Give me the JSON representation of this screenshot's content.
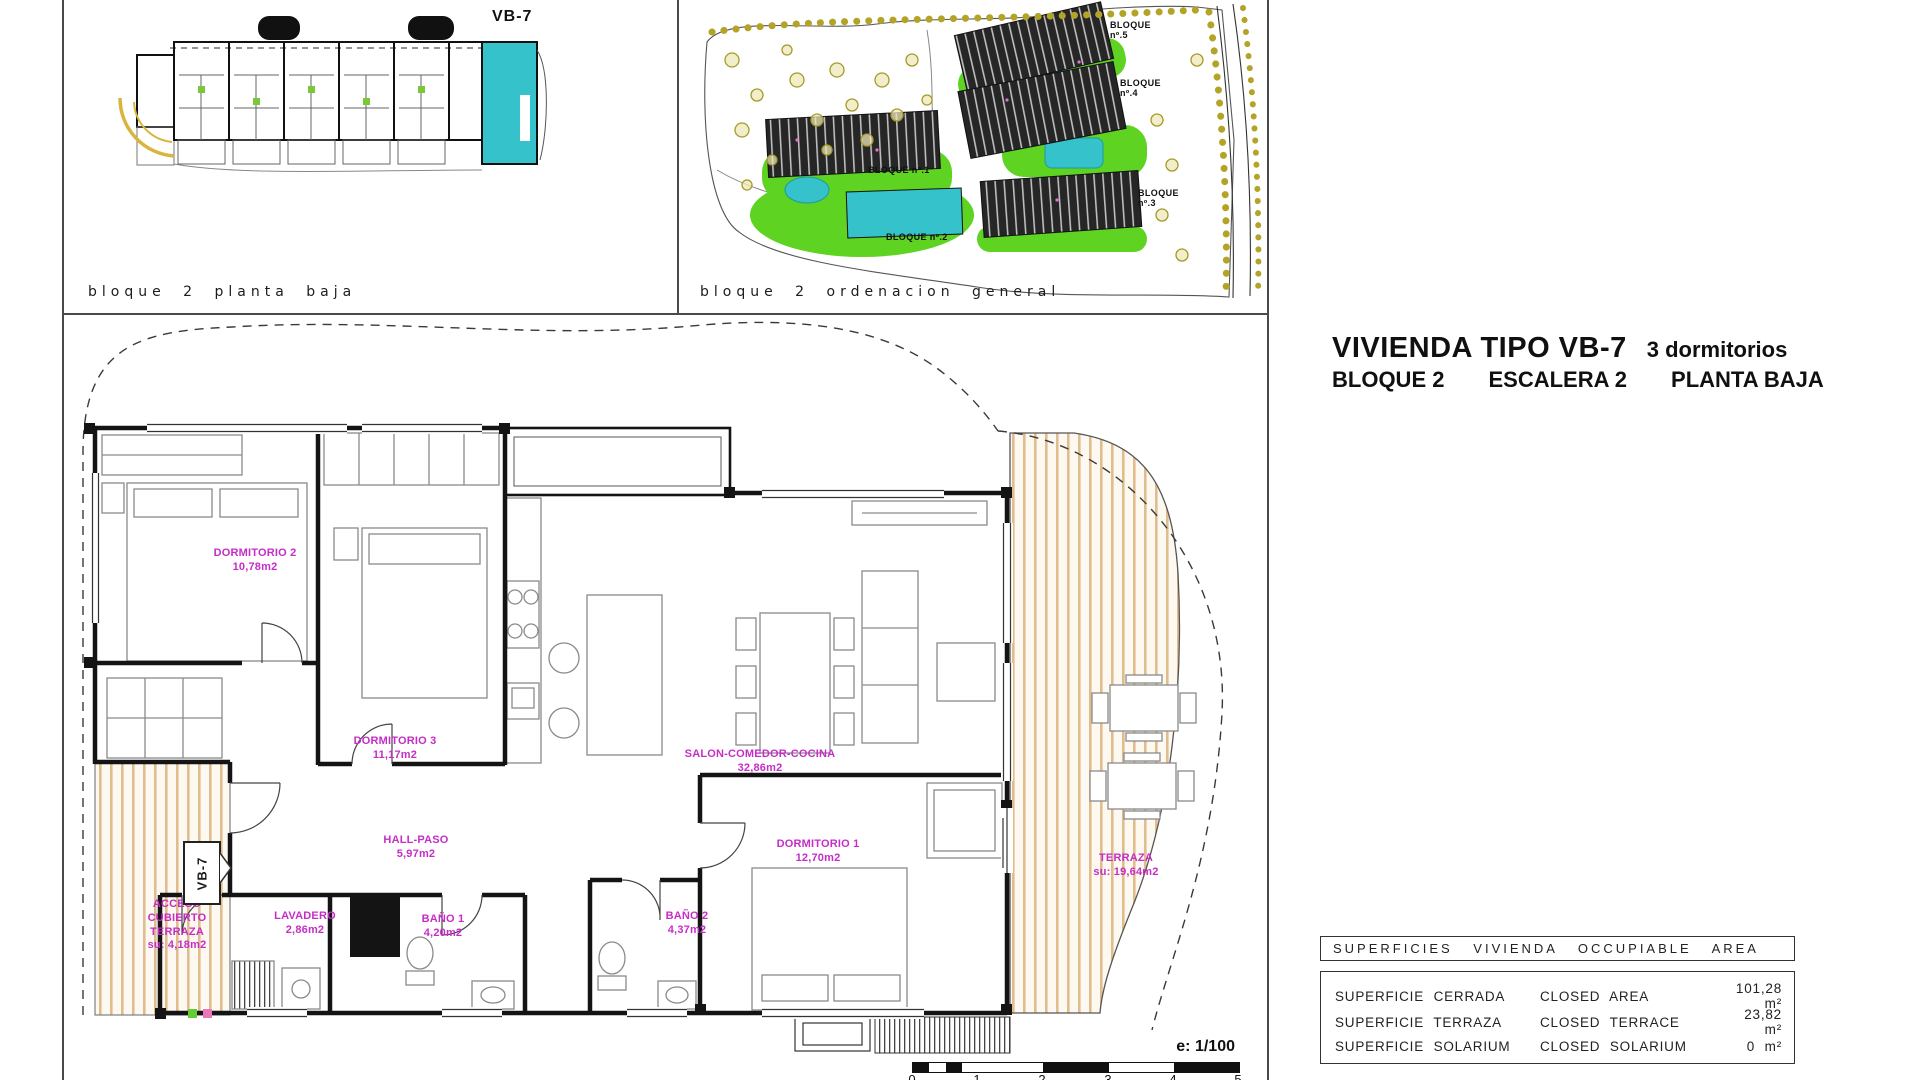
{
  "panels": {
    "block_plan": {
      "caption": "bloque 2 planta baja",
      "unit_label": "VB-7"
    },
    "site_plan": {
      "caption": "bloque 2 ordenacion general",
      "bloque_labels": [
        {
          "text": "BLOQUE\nnº.5"
        },
        {
          "text": "BLOQUE\nnº.4"
        },
        {
          "text": "BLOQUE nº.1"
        },
        {
          "text": "BLOQUE\nnº.3"
        },
        {
          "text": "BLOQUE nº.2"
        }
      ]
    }
  },
  "title_block": {
    "type_title": "VIVIENDA TIPO VB-7",
    "bedrooms": "3 dormitorios",
    "block": "BLOQUE 2",
    "stair": "ESCALERA 2",
    "floor": "PLANTA BAJA"
  },
  "floor_plan": {
    "unit_tag": "VB-7",
    "rooms": [
      {
        "name": "DORMITORIO 2",
        "area": "10,78m2"
      },
      {
        "name": "DORMITORIO 3",
        "area": "11,17m2"
      },
      {
        "name": "SALON-COMEDOR-COCINA",
        "area": "32,86m2"
      },
      {
        "name": "HALL-PASO",
        "area": "5,97m2"
      },
      {
        "name": "DORMITORIO 1",
        "area": "12,70m2"
      },
      {
        "name": "LAVADERO",
        "area": "2,86m2"
      },
      {
        "name": "BAÑO 1",
        "area": "4,20m2"
      },
      {
        "name": "BAÑO 2",
        "area": "4,37m2"
      },
      {
        "name": "TERRAZA",
        "area": "su: 19,64m2"
      },
      {
        "name": "ACCESO CUBIERTO TERRAZA",
        "area": "su: 4,18m2"
      }
    ]
  },
  "scale_bar": {
    "label": "e: 1/100",
    "ticks": [
      "0",
      "1",
      "2",
      "3",
      "4",
      "5"
    ]
  },
  "areas_table": {
    "header": "SUPERFICIES VIVIENDA OCCUPIABLE AREA",
    "rows": [
      {
        "label_es": "SUPERFICIE CERRADA",
        "label_en": "CLOSED AREA",
        "value": "101,28 m²"
      },
      {
        "label_es": "SUPERFICIE TERRAZA",
        "label_en": "CLOSED TERRACE",
        "value": "23,82 m²"
      },
      {
        "label_es": "SUPERFICIE SOLARIUM",
        "label_en": "CLOSED SOLARIUM",
        "value": "0 m²"
      }
    ]
  },
  "colors": {
    "highlight_cyan": "#35c2cb",
    "room_label_magenta": "#c52dc7",
    "deck_stripe_tan": "#dfbd8e",
    "vegetation_green": "#5ed321",
    "tree_olive": "#b3a428"
  }
}
